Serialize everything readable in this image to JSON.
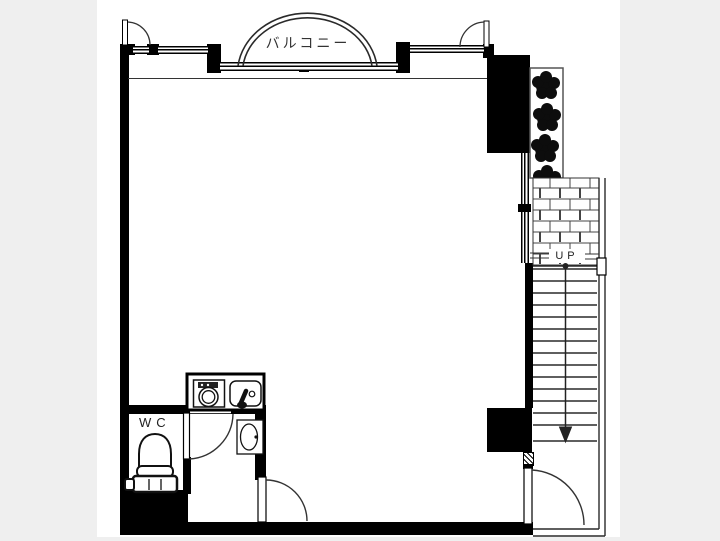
{
  "title": "apartment-floor-plan",
  "labels": {
    "balcony": "バルコニー",
    "wc": "WC",
    "up": "UP"
  },
  "colors": {
    "background": "#efefef",
    "paper": "#ffffff",
    "wall": "#000000",
    "line": "#2a2a2a",
    "brick_joint": "#444444",
    "foliage": "#0d0d0d"
  },
  "fixtures": {
    "toilet": "toilet",
    "wash_basin": "wash-basin",
    "stove": "single-burner-stove",
    "kitchen_sink": "kitchen-sink-with-faucet",
    "stairs": "staircase-going-up",
    "planter": "planter-with-shrubs",
    "paving": "brick-paving",
    "balcony_shape": "semicircular-balcony"
  }
}
